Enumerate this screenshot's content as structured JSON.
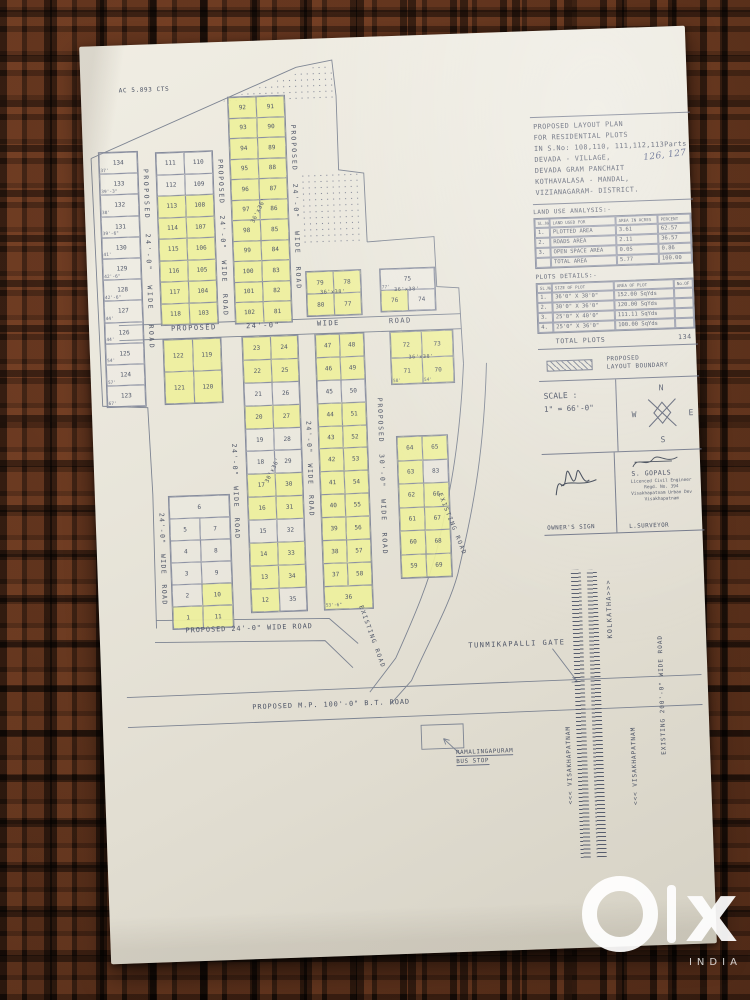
{
  "watermark": {
    "x": "x",
    "country": "INDIA"
  },
  "map": {
    "area_note": "AC 5.893 CTS",
    "roads": {
      "v1": "PROPOSED 24'-0\" WIDE ROAD",
      "v2": "PROPOSED 24'-0\" WIDE ROAD",
      "v3": "PROPOSED 24'-0\" WIDE ROAD",
      "v5": "24'-0\" WIDE ROAD",
      "v6": "24'-0\" WIDE ROAD",
      "v7": "PROPOSED 30'-0\" WIDE ROAD",
      "v8": "24'-0\" WIDE ROAD",
      "h1": "PROPOSED",
      "h2": "24'-0\"",
      "h3": "WIDE",
      "h4": "ROAD",
      "h_bottom": "PROPOSED  24'-0\"  WIDE  ROAD",
      "mp_road": "PROPOSED    M.P.  100'-0\"   B.T.  ROAD",
      "existing1": "EXISTING ROAD",
      "existing2": "EXISTING ROAD",
      "existing200": "EXISTING 200'-0\" WIDE ROAD"
    },
    "places": {
      "kolkatha": "KOLKATHA>>>",
      "vizag1": "<<< VISAKHAPATNAM",
      "vizag2": "<<< VISAKHAPATNAM",
      "gate": "TUNMIKAPALLI GATE",
      "bus_stop1": "RAMALINGAPURAM",
      "bus_stop2": "BUS STOP"
    },
    "measures": {
      "m3636": "36'x36'",
      "m3036": "30'x36'",
      "mc": "36'x38'",
      "md": "36'x38'",
      "mh": "36'x38'"
    },
    "plots": {
      "left_strip": [
        [
          {
            "n": "134",
            "m": "37'",
            "w": 1
          }
        ],
        [
          {
            "n": "133",
            "m": "39'-3\"",
            "w": 1
          }
        ],
        [
          {
            "n": "132",
            "m": "38'",
            "w": 1
          }
        ],
        [
          {
            "n": "131",
            "m": "39'-6\"",
            "w": 1
          }
        ],
        [
          {
            "n": "130",
            "m": "41'",
            "w": 1
          }
        ],
        [
          {
            "n": "129",
            "m": "42'-6\"",
            "w": 1
          }
        ],
        [
          {
            "n": "128",
            "m": "42'-6\"",
            "w": 1
          }
        ],
        [
          {
            "n": "127",
            "m": "44'",
            "w": 1
          }
        ],
        [
          {
            "n": "126",
            "m": "44'",
            "w": 1
          }
        ],
        [
          {
            "n": "125",
            "m": "54'",
            "w": 1
          }
        ],
        [
          {
            "n": "124",
            "m": "57'",
            "w": 1
          }
        ],
        [
          {
            "n": "123",
            "m": "67'",
            "w": 1
          }
        ]
      ],
      "col111": [
        [
          {
            "n": "111",
            "w": 1
          },
          {
            "n": "110",
            "w": 1
          }
        ],
        [
          {
            "n": "112",
            "w": 1
          },
          {
            "n": "109",
            "w": 1
          }
        ],
        [
          "113",
          "108"
        ],
        [
          "114",
          "107"
        ],
        [
          "115",
          "106"
        ],
        [
          "116",
          "105"
        ],
        [
          "117",
          "104"
        ],
        [
          "118",
          "103"
        ]
      ],
      "top_col": [
        [
          "92",
          "91"
        ],
        [
          "93",
          "90"
        ],
        [
          "94",
          "89"
        ],
        [
          "95",
          "88"
        ],
        [
          "96",
          "87"
        ],
        [
          "97",
          "86"
        ],
        [
          "98",
          "85"
        ],
        [
          "99",
          "84"
        ],
        [
          "100",
          "83"
        ],
        [
          "101",
          "82"
        ],
        [
          "102",
          "81"
        ]
      ],
      "blk_c": [
        [
          "79",
          "78"
        ],
        [
          "80",
          "77"
        ]
      ],
      "blk_d": [
        [
          {
            "n": "75",
            "m": "77'",
            "w": 1
          }
        ],
        [
          "76",
          {
            "n": "74",
            "w": 1
          }
        ]
      ],
      "blk_e": [
        [
          "122",
          "119"
        ],
        [
          "121",
          "120"
        ]
      ],
      "blk_f": [
        [
          "23",
          "24"
        ],
        [
          "22",
          "25"
        ],
        [
          {
            "n": "21",
            "w": 1
          },
          {
            "n": "26",
            "w": 1
          }
        ],
        [
          "20",
          "27"
        ],
        [
          {
            "n": "19",
            "w": 1
          },
          {
            "n": "28",
            "w": 1
          }
        ],
        [
          {
            "n": "18",
            "w": 1
          },
          {
            "n": "29",
            "w": 1
          }
        ],
        [
          "17",
          "30"
        ],
        [
          "16",
          "31"
        ],
        [
          {
            "n": "15",
            "w": 1
          },
          {
            "n": "32",
            "w": 1
          }
        ],
        [
          "14",
          "33"
        ],
        [
          "13",
          "34"
        ],
        [
          "12",
          {
            "n": "35",
            "w": 1
          }
        ]
      ],
      "blk_g": [
        [
          "47",
          "48"
        ],
        [
          "46",
          "49"
        ],
        [
          {
            "n": "45",
            "w": 1
          },
          {
            "n": "50",
            "w": 1
          }
        ],
        [
          "44",
          "51"
        ],
        [
          "43",
          "52"
        ],
        [
          "42",
          "53"
        ],
        [
          "41",
          "54"
        ],
        [
          "40",
          "55"
        ],
        [
          "39",
          "56"
        ],
        [
          "38",
          "57"
        ],
        [
          "37",
          "58"
        ],
        [
          {
            "n": "36",
            "m": "53'-6\""
          }
        ]
      ],
      "blk_h": [
        [
          "72",
          "73"
        ],
        [
          {
            "n": "71",
            "m": "58'"
          },
          {
            "n": "70",
            "m": "54'"
          }
        ]
      ],
      "blk_i": [
        [
          "64",
          "65"
        ],
        [
          "63",
          {
            "n": "83",
            "w": 1
          }
        ],
        [
          "62",
          "66"
        ],
        [
          "61",
          "67"
        ],
        [
          "60",
          "68"
        ],
        [
          "59",
          "69"
        ]
      ],
      "blk_low": [
        [
          {
            "n": "6",
            "w": 1
          }
        ],
        [
          {
            "n": "5",
            "w": 1
          },
          {
            "n": "7",
            "w": 1
          }
        ],
        [
          {
            "n": "4",
            "w": 1
          },
          {
            "n": "8",
            "w": 1
          }
        ],
        [
          {
            "n": "3",
            "w": 1
          },
          {
            "n": "9",
            "w": 1
          }
        ],
        [
          {
            "n": "2",
            "w": 1
          },
          "10"
        ],
        [
          "1",
          "11"
        ]
      ]
    }
  },
  "panel": {
    "title_lines": [
      "PROPOSED LAYOUT PLAN",
      "FOR RESIDENTIAL PLOTS",
      "IN S.No: 108,110, 111,112,113Parts",
      "DEVADA - VILLAGE,",
      "DEVADA  GRAM PANCHAIT",
      "KOTHAVALASA - MANDAL,",
      "VIZIANAGARAM-  DISTRICT."
    ],
    "handwritten": "126, 127",
    "land_use": {
      "title": "LAND USE ANALYSIS:-",
      "headers": [
        "SL.No",
        "LAND USED FOR",
        "AREA IN ACRES",
        "PERCENT"
      ],
      "rows": [
        [
          "1.",
          "PLOTTED AREA",
          "3.61",
          "62.57"
        ],
        [
          "2.",
          "ROADS AREA",
          "2.11",
          "36.57"
        ],
        [
          "3.",
          "OPEN SPACE AREA",
          "0.05",
          "0.86"
        ]
      ],
      "total_label": "TOTAL  AREA",
      "total_area": "5.77",
      "total_pct": "100.00"
    },
    "plot_details": {
      "title": "PLOTS DETAILS:-",
      "headers": [
        "SL.No",
        "SIZE OF PLOT",
        "AREA OF PLOT",
        "No.OF"
      ],
      "rows": [
        [
          "1.",
          "36'0\" X 38'0\"",
          "152.00 SqYds"
        ],
        [
          "2.",
          "30'0\" X 36'0\"",
          "120.00 SqYds"
        ],
        [
          "3.",
          "25'0\" X 40'0\"",
          "111.11 SqYds"
        ],
        [
          "4.",
          "25'0\" X 36'0\"",
          "100.00 SqYds"
        ]
      ]
    },
    "total_plots_label": "TOTAL  PLOTS",
    "total_plots_value": "134",
    "legend1": "PROPOSED",
    "legend2": "LAYOUT  BOUNDARY",
    "scale_label": "SCALE :",
    "scale_value": "1\" = 66'-0\"",
    "compass": {
      "n": "N",
      "e": "E",
      "s": "S",
      "w": "W"
    },
    "owner_sign_label": "OWNER'S SIGN",
    "surveyor": {
      "name": "S. GOPALS",
      "line1": "Licenced Civil Engineer",
      "line2": "Regd. No. 394",
      "line3": "Visakhapatnam Urban Dev",
      "line4": "Visakhapatnam",
      "label": "L.SURVEYOR"
    }
  }
}
